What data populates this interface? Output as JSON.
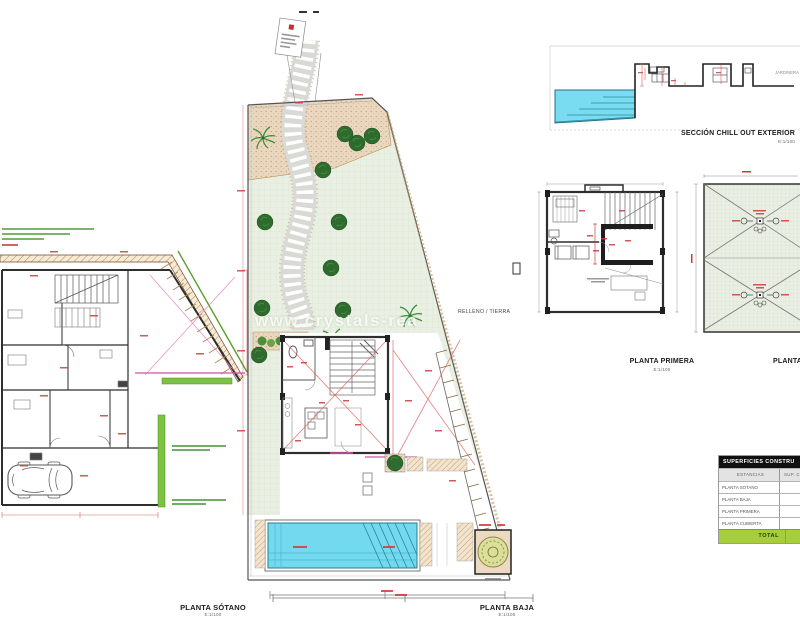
{
  "drawing": {
    "labels": {
      "planta_sotano": {
        "title": "PLANTA SÓTANO",
        "scale": "E:1/100"
      },
      "planta_baja": {
        "title": "PLANTA BAJA",
        "scale": "E:1/100"
      },
      "planta_primera": {
        "title": "PLANTA PRIMERA",
        "scale": "E:1/100"
      },
      "planta_cubierta": {
        "title": "PLANTA C"
      },
      "seccion": {
        "title": "SECCIÓN CHILL OUT EXTERIOR",
        "scale": "E:1/100"
      }
    },
    "annotations": {
      "relleno_tierra": "RELLENO / TIERRA",
      "jardinera": "JARDINERA",
      "watermark": "www.crystals-rea"
    }
  },
  "table": {
    "title": "SUPERFICIES CONSTRU",
    "headers": {
      "estancias": "ESTANCIAS",
      "superficie": "SUP. CON"
    },
    "rows": [
      {
        "label": "PLANTA SOTANO",
        "value": "184"
      },
      {
        "label": "PLANTA BAJA",
        "value": "87"
      },
      {
        "label": "PLANTA PRIMERA",
        "value": "87"
      },
      {
        "label": "PLANTA CUBIERTA",
        "value": ""
      }
    ],
    "total": {
      "label": "TOTAL",
      "value": ""
    },
    "accent_green": "#a6ce39"
  },
  "colors": {
    "pool": "#72d9ee",
    "lawn": "#e9efe3",
    "garden": "#ead7bf",
    "green_strip": "#7dc242",
    "dimension_red": "#cc3b3b",
    "magenta": "#d84fa8",
    "wall": "#2e2e2e"
  }
}
